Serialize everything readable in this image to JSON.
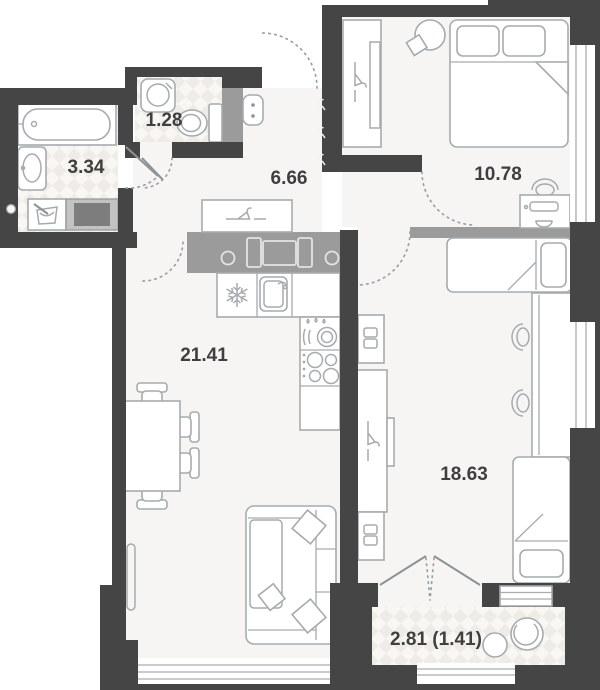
{
  "plan": {
    "title": "apartment-floor-plan",
    "rooms": [
      {
        "name": "bathroom",
        "area": "3.34"
      },
      {
        "name": "wc",
        "area": "1.28"
      },
      {
        "name": "hallway",
        "area": "6.66"
      },
      {
        "name": "bedroom",
        "area": "10.78"
      },
      {
        "name": "kitchen-living-room",
        "area": "21.41"
      },
      {
        "name": "bedroom-2",
        "area": "18.63"
      },
      {
        "name": "balcony",
        "area": "2.81 (1.41)"
      }
    ],
    "colors": {
      "wall": "#454545",
      "vent_shaft": "#9b9b9b",
      "floor": "#f6f5f3",
      "tile_dark": "#efece8",
      "tile_light": "#f9f7f4",
      "furniture_stroke": "#a6abae",
      "label_text": "#3f3f3f"
    }
  }
}
